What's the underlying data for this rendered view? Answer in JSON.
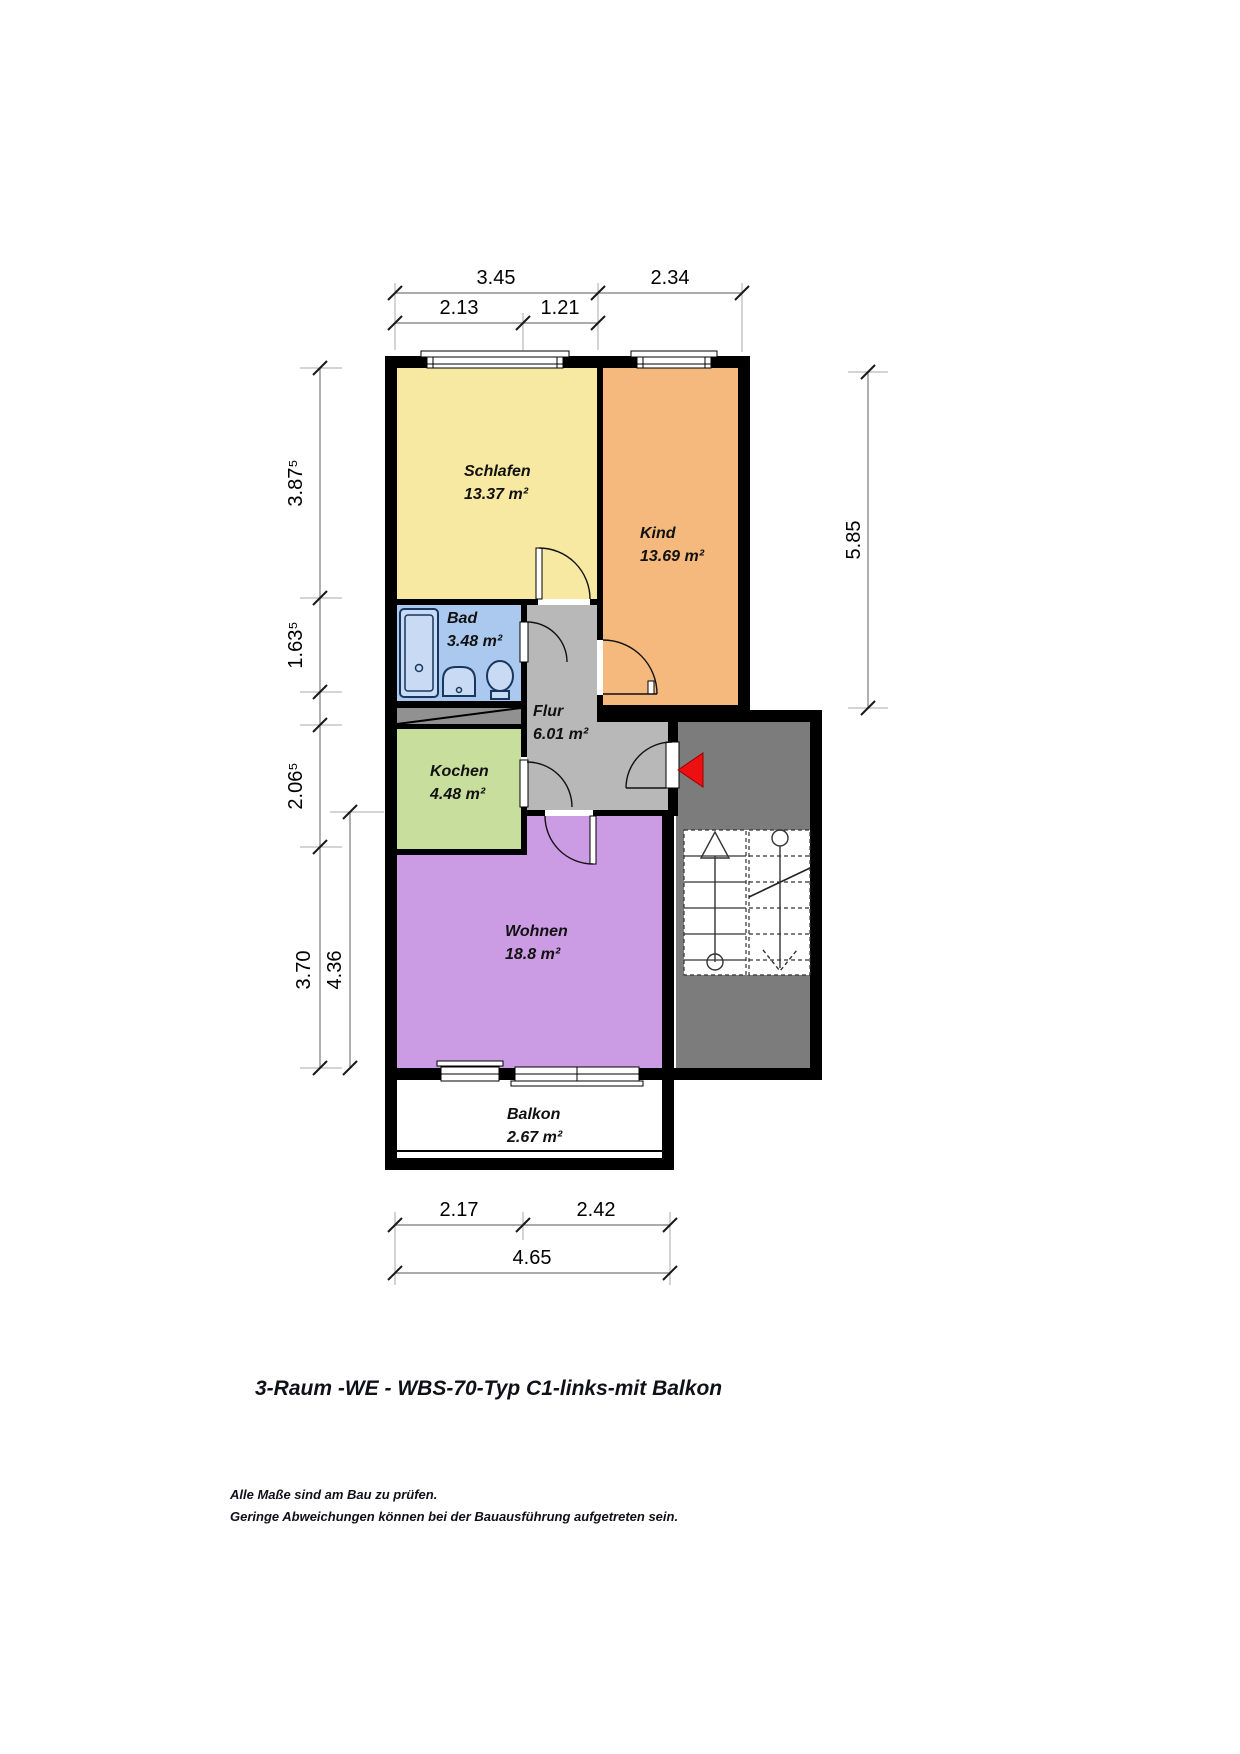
{
  "title": "3-Raum -WE - WBS-70-Typ C1-links-mit Balkon",
  "notes": [
    "Alle Maße sind am Bau zu prüfen.",
    "Geringe Abweichungen können bei der Bauausführung aufgetreten sein."
  ],
  "rooms": {
    "schlafen": {
      "name": "Schlafen",
      "area": "13.37 m²",
      "color": "#f8e9a2"
    },
    "kind": {
      "name": "Kind",
      "area": "13.69 m²",
      "color": "#f5b97e"
    },
    "bad": {
      "name": "Bad",
      "area": "3.48 m²",
      "color": "#abc9ee"
    },
    "flur": {
      "name": "Flur",
      "area": "6.01 m²",
      "color": "#b8b8b8"
    },
    "kochen": {
      "name": "Kochen",
      "area": "4.48 m²",
      "color": "#c8de9d"
    },
    "wohnen": {
      "name": "Wohnen",
      "area": "18.8 m²",
      "color": "#cb9ce4"
    },
    "balkon": {
      "name": "Balkon",
      "area": "2.67 m²",
      "color": "#ffffff"
    }
  },
  "dimensions": {
    "top_row1": [
      "3.45",
      "2.34"
    ],
    "top_row2": [
      "2.13",
      "1.21"
    ],
    "left_outer": [
      "3.87⁵",
      "1.63⁵",
      "2.06⁵",
      "3.70"
    ],
    "left_inner": "4.36",
    "right": "5.85",
    "bottom_row1": [
      "2.17",
      "2.42"
    ],
    "bottom_row2": "4.65"
  },
  "colors": {
    "wall": "#000000",
    "stairwell": "#7c7c7c",
    "shaft": "#919191",
    "entrance_arrow": "#ee1010",
    "fixture_outline": "#17375e"
  }
}
